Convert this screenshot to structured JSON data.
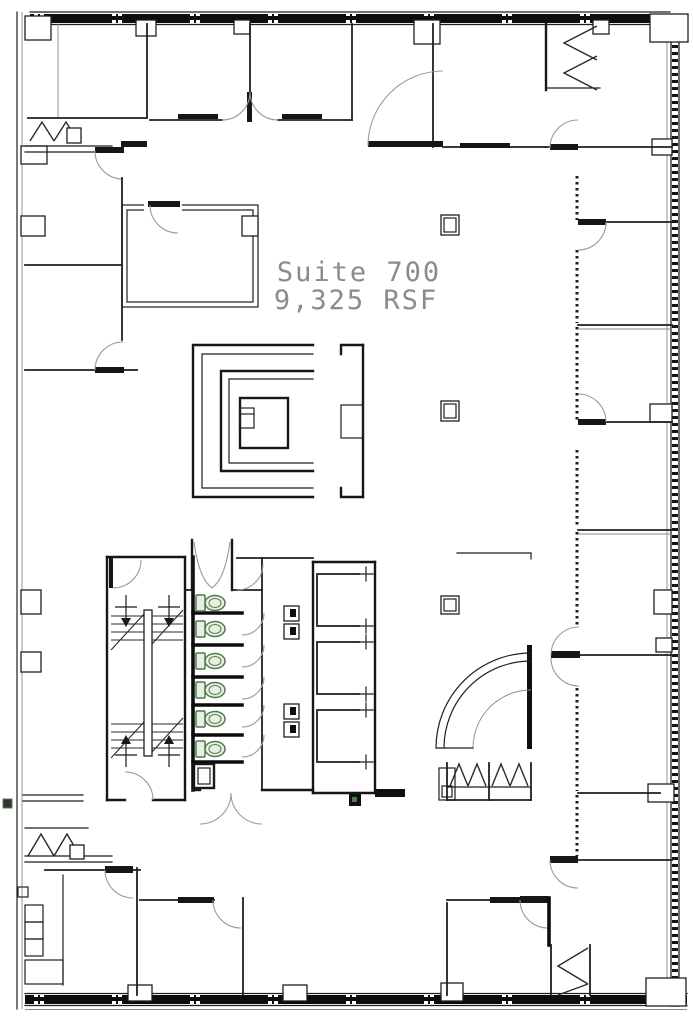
{
  "labels": {
    "suite": "Suite 700",
    "area": "9,325 RSF"
  },
  "colors": {
    "background": "#ffffff",
    "wall_line": "#1f1f1f",
    "wall_fill": "#0d0d0d",
    "door_arc": "#9b9b9b",
    "label_text": "#8b8b8b",
    "fixture_outline": "#4e7c49",
    "fixture_fill": "#e8efe3"
  },
  "fixtures": {
    "toilet_count": 6,
    "elevator_cab_count": 3,
    "stair_flight_count": 2
  }
}
